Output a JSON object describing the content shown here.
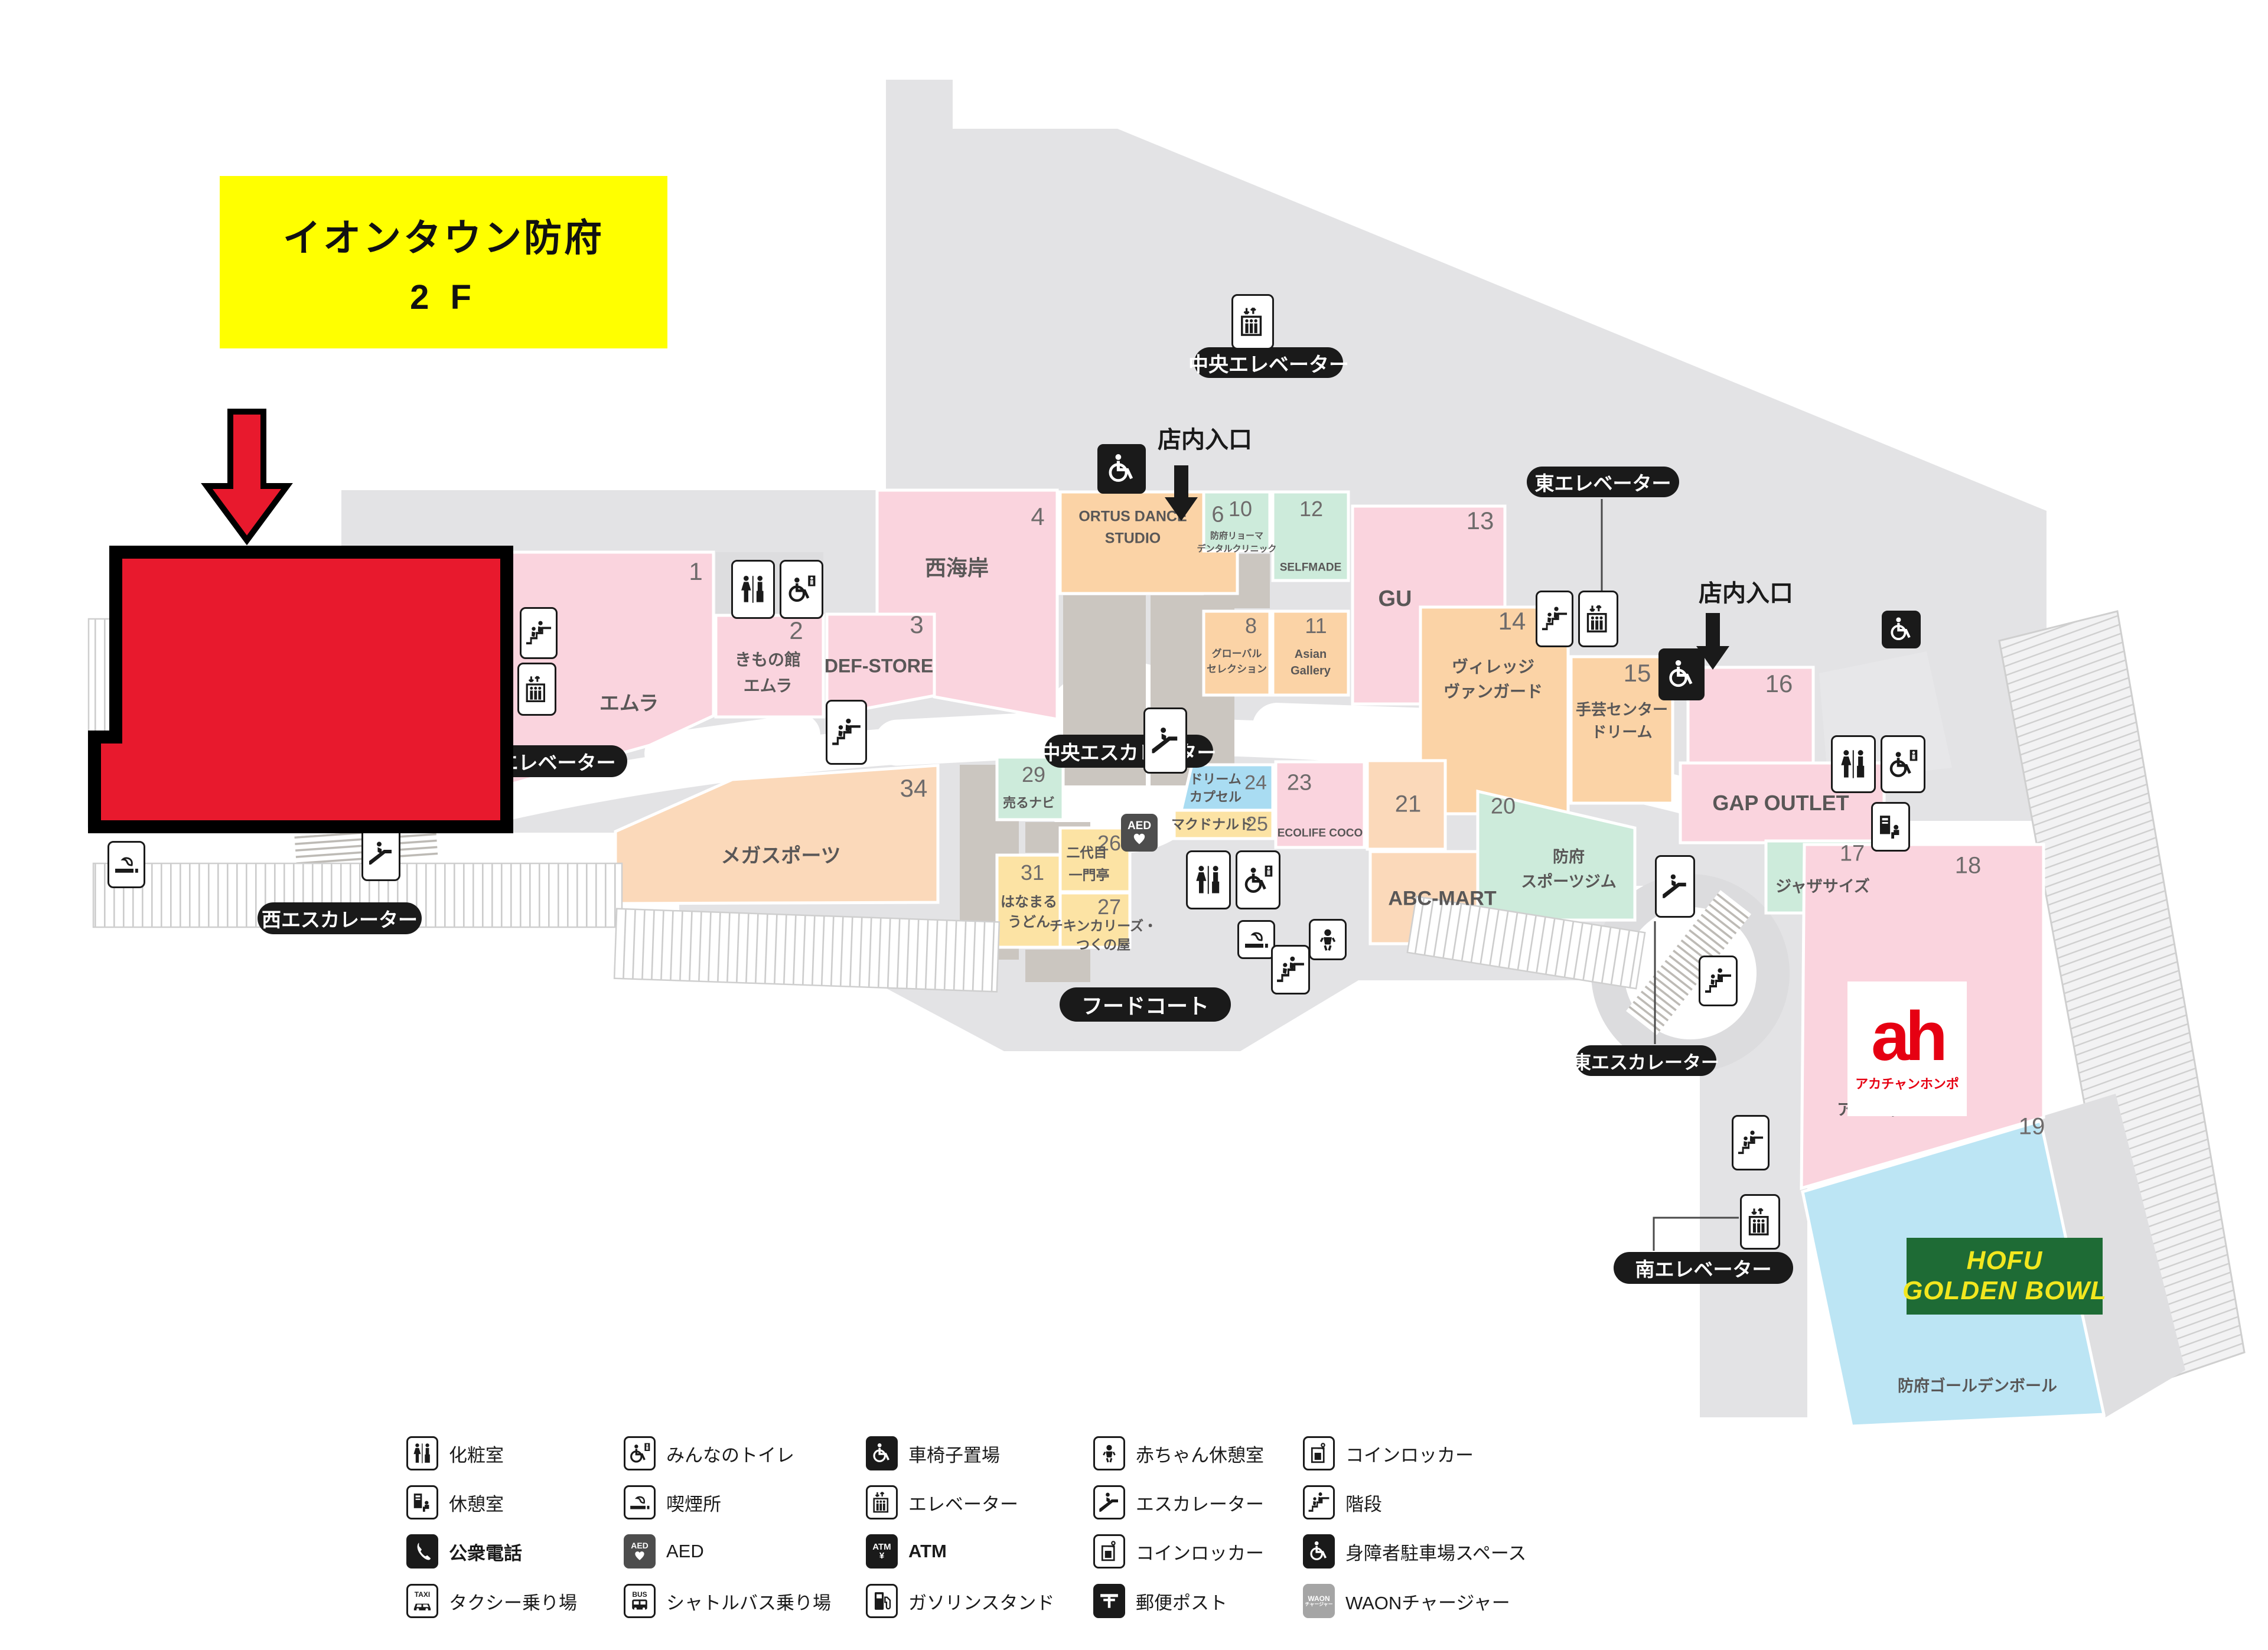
{
  "title": {
    "line1": "イオンタウン防府",
    "line2": "2 F"
  },
  "pills": {
    "central_elevator": "中央エレベーター",
    "east_elevator": "東エレベーター",
    "west_elevator": "西エレベーター",
    "south_elevator": "南エレベーター",
    "west_escalator": "西エスカレーター",
    "central_escalator": "中央エスカレーター",
    "east_escalator": "東エスカレーター",
    "food_court": "フードコート"
  },
  "entrance_label": "店内入口",
  "units": {
    "u1": {
      "no": "1"
    },
    "u2": {
      "no": "2",
      "l1": "きもの館",
      "l2": "エムラ"
    },
    "emura": {
      "name": "エムラ"
    },
    "u3": {
      "no": "3",
      "name": "DEF-STORE"
    },
    "u4": {
      "no": "4",
      "name": "西海岸"
    },
    "u6": {
      "no": "6",
      "l1": "ORTUS DANCE",
      "l2": "STUDIO"
    },
    "u8": {
      "no": "8",
      "l1": "グローバル",
      "l2": "セレクション"
    },
    "u10": {
      "no": "10",
      "l1": "防府リョーマ",
      "l2": "デンタルクリニック"
    },
    "u11": {
      "no": "11",
      "l1": "Asian",
      "l2": "Gallery"
    },
    "u12": {
      "no": "12",
      "name": "SELFMADE"
    },
    "u13": {
      "no": "13",
      "name": "GU"
    },
    "u14": {
      "no": "14",
      "l1": "ヴィレッジ",
      "l2": "ヴァンガード"
    },
    "u15": {
      "no": "15",
      "l1": "手芸センター",
      "l2": "ドリーム"
    },
    "u16": {
      "no": "16"
    },
    "u17": {
      "no": "17",
      "name": "ジャザサイズ"
    },
    "u18": {
      "no": "18"
    },
    "u19": {
      "no": "19"
    },
    "u20": {
      "no": "20",
      "l1": "防府",
      "l2": "スポーツジム"
    },
    "u21": {
      "no": "21"
    },
    "u23": {
      "no": "23",
      "name": "ECOLIFE COCO"
    },
    "u24": {
      "no": "24",
      "l1": "ドリーム",
      "l2": "カプセル"
    },
    "u25": {
      "no": "25",
      "name": "マクドナルド"
    },
    "u26": {
      "no": "26",
      "l1": "二代目",
      "l2": "一門亭"
    },
    "u27": {
      "no": "27",
      "l1": "チキンカリーズ・",
      "l2": "つくの屋"
    },
    "u29": {
      "no": "29",
      "name": "売るナビ"
    },
    "u31": {
      "no": "31",
      "l1": "はなまる",
      "l2": "うどん"
    },
    "u34": {
      "no": "34",
      "name": "メガスポーツ"
    },
    "abc": {
      "name": "ABC-MART"
    },
    "gap": {
      "name": "GAP OUTLET"
    },
    "akachan": {
      "name": "アカチャンホンポ"
    },
    "bowl": {
      "name": "防府ゴールデンボール"
    }
  },
  "ah_logo": {
    "mark": "ah",
    "text": "アカチャンホンポ"
  },
  "bowl_banner": {
    "l1": "HOFU",
    "l2": "GOLDEN BOWL"
  },
  "icon_text": {
    "aed": "AED",
    "atm": "ATM",
    "yen": "¥",
    "taxi": "TAXI",
    "bus": "BUS",
    "waon1": "WAON",
    "waon2": "チャージャー"
  },
  "legend": {
    "items": [
      {
        "label": "化粧室"
      },
      {
        "label": "みんなのトイレ"
      },
      {
        "label": "車椅子置場"
      },
      {
        "label": "赤ちゃん休憩室"
      },
      {
        "label": "コインロッカー"
      },
      {
        "label": "休憩室"
      },
      {
        "label": "喫煙所"
      },
      {
        "label": "エレベーター"
      },
      {
        "label": "エスカレーター"
      },
      {
        "label": "階段"
      },
      {
        "label": "公衆電話",
        "bold": true
      },
      {
        "label": "AED"
      },
      {
        "label": "ATM",
        "bold": true
      },
      {
        "label": "コインロッカー"
      },
      {
        "label": "身障者駐車場スペース"
      },
      {
        "label": "タクシー乗り場"
      },
      {
        "label": "シャトルバス乗り場"
      },
      {
        "label": "ガソリンスタンド"
      },
      {
        "label": "郵便ポスト"
      },
      {
        "label": "WAONチャージャー"
      }
    ]
  }
}
